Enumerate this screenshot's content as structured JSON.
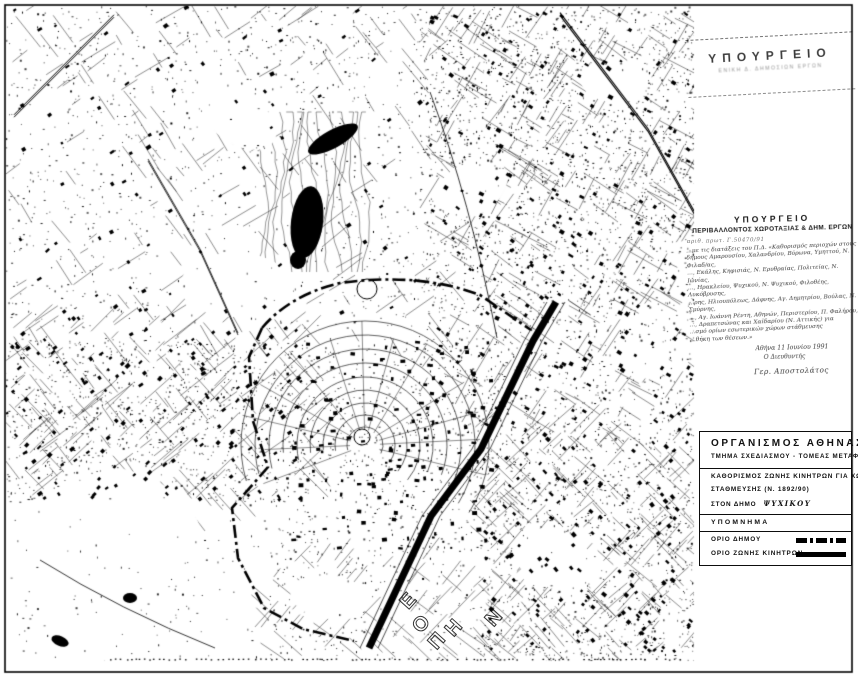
{
  "stamps": {
    "ministry_top": {
      "title": "ΥΠΟΥΡΓΕΙΟ",
      "subtitle": "ΕΝΙΚΗ   Δ.              ΔΗΜΟΣΙΩΝ   ΕΡΓΩΝ"
    },
    "ministry_main": {
      "title": "ΥΠΟΥΡΓΕΙΟ",
      "subtitle": "ΠΕΡΙΒΑΛΛΟΝΤΟΣ ΧΩΡΟΤΑΞΙΑΣ & ΔΗΜ. ΕΡΓΩΝ",
      "protocol": "αριθ. πρωτ.  Γ.50470/91",
      "note_lines": [
        "…με τις διατάξεις του Π.Δ. «Καθορισμός περιοχών στους",
        "δήμους Αμαρουσίου, Χαλανδρίου, Βύρωνα, Υμηττού, Ν. Φιλαδ/ας,",
        "…, Εκάλης, Κηφισιάς, Ν. Ερυθραίας, Πολιτείας, Ν. Ιωνίας,",
        "…, Ηρακλείου, Ψυχικού, Ν. Ψυχικού, Φιλοθέης, Λυκόβρυσης,",
        "…ρης, Ηλιουπόλεως, Δάφνης, Αγ. Δημητρίου, Βούλας, Ν. Σμύρνης,",
        "…, Αγ. Ιωάννη Ρέντη, Αθηνών, Περιστερίου, Π. Φαλήρου,",
        "…, Δραπετσώνας και Χαϊδαρίου (Ν. Αττικής) για",
        "…σμό ορίων εσωτερικών χώρων στάθμευσης",
        "…θήκη των θέσεων.»"
      ],
      "date": "Αθήνα 11 Ιουνίου 1991",
      "signoff": "Ο Διευθυντής",
      "signature": "Γερ. Αποστολάτος"
    }
  },
  "title_block": {
    "organization": "ΟΡΓΑΝΙΣΜΟΣ  ΑΘΗΝΑΣ",
    "department": "ΤΜΗΜΑ ΣΧΕΔΙΑΣΜΟΥ - ΤΟΜΕΑΣ ΜΕΤΑΦΟΡΩΝ",
    "subject_line1": "ΚΑΘΟΡΙΣΜΟΣ ΖΩΝΗΣ ΚΙΝΗΤΡΩΝ ΓΙΑ ΧΩΡΟΥΣ",
    "subject_line2": "ΣΤΑΘΜΕΥΣΗΣ (Ν. 1892/90)",
    "subject_line3_label": "ΣΤΟΝ ΔΗΜΟ",
    "municipality": "ΨΥΧΙΚΟΥ",
    "legend_title": "ΥΠΟΜΝΗΜΑ",
    "legend_items": [
      {
        "label": "ΟΡΙΟ ΔΗΜΟΥ",
        "symbol": "dash-dot-line"
      },
      {
        "label": "ΟΡΙΟ ΖΩΝΗΣ ΚΙΝΗΤΡΩΝ",
        "symbol": "solid-thick-line"
      }
    ]
  },
  "map": {
    "ink": "#000000",
    "paper": "#ffffff",
    "sheet_letters": [
      {
        "ch": "Ε",
        "x": 402,
        "y": 590,
        "rot": -48
      },
      {
        "ch": "Ο",
        "x": 414,
        "y": 613,
        "rot": -48
      },
      {
        "ch": "Π",
        "x": 430,
        "y": 630,
        "rot": -48
      },
      {
        "ch": "Η",
        "x": 447,
        "y": 617,
        "rot": -48
      },
      {
        "ch": "Ν",
        "x": 487,
        "y": 607,
        "rot": -48
      }
    ]
  }
}
